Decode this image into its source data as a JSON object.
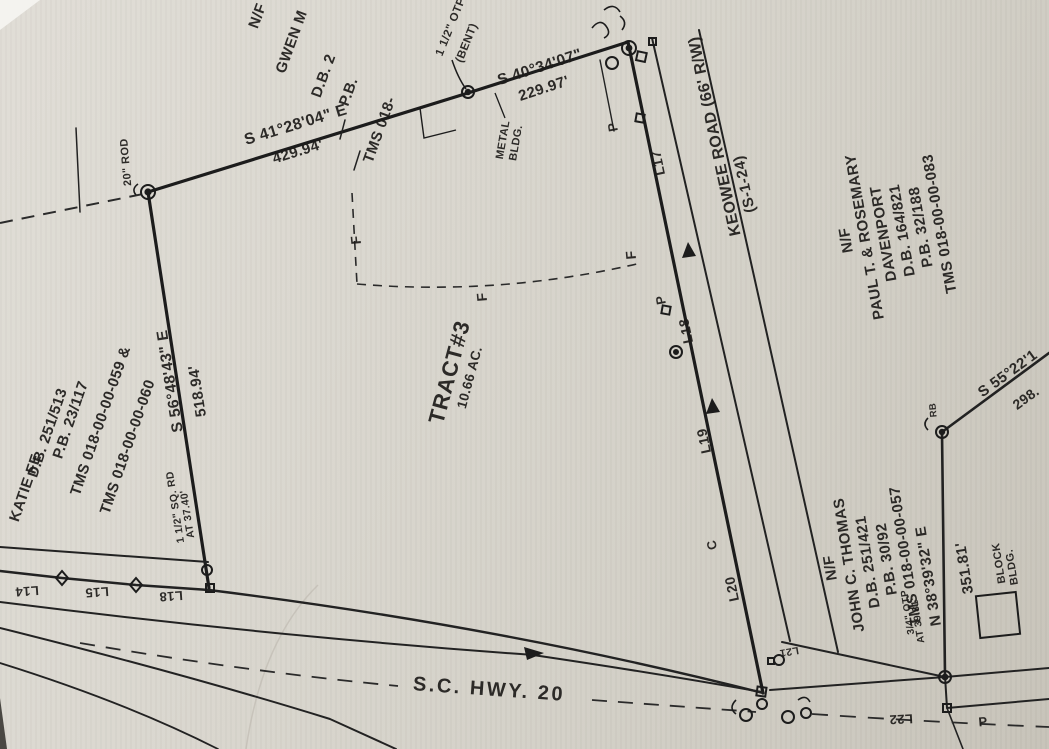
{
  "plat": {
    "tract": {
      "name": "TRACT#3",
      "area": "10.66 AC."
    },
    "roads": {
      "keowee_name": "KEOWEE ROAD (66' R/W)",
      "keowee_route": "(S-1-24)",
      "hwy_name": "S.C. HWY. 20"
    },
    "adjoiners": {
      "north": {
        "nf": "N/F",
        "name": "GWEN M",
        "db": "D.B. 2",
        "pb": "P.B.",
        "tms": "TMS 018-"
      },
      "west": {
        "name": "KATIE FE",
        "db": "D.B. 251/513",
        "pb": "P.B. 23/117",
        "tms1": "TMS 018-00-00-059 &",
        "tms2": "TMS 018-00-00-060"
      },
      "east": {
        "nf": "N/F",
        "name1": "PAUL T. & ROSEMARY",
        "name2": "DAVENPORT",
        "db": "D.B. 164/821",
        "pb": "P.B. 32/188",
        "tms": "TMS 018-00-00-083"
      },
      "south": {
        "nf": "N/F",
        "name": "JOHN C. THOMAS",
        "db": "D.B. 251/421",
        "pb": "P.B. 30/92",
        "tms": "TMS 018-00-00-057"
      }
    },
    "bearings": {
      "north1": {
        "b": "S 41°28'04\" E",
        "d": "429.94'"
      },
      "north2": {
        "b": "S 40°34'07\"",
        "d": "229.97'"
      },
      "west": {
        "b": "S 56°48'43\" E",
        "d": "518.94'"
      },
      "right": {
        "b": "N 38°39'32\" E",
        "d": "351.81'"
      },
      "northeast": {
        "b": "S 55°22'1",
        "d": "298."
      }
    },
    "monuments": {
      "rod20": "20\" ROD",
      "otp_bent_1": "1 1/2\" OTP",
      "otp_bent_2": "(BENT)",
      "sq_rd_1": "1 1/2\" SQ. RD",
      "sq_rd_2": "AT 37.40'",
      "otp34_1": "3/4\" OTP",
      "otp34_2": "AT 39.81'",
      "rb": "RB"
    },
    "buildings": {
      "metal_1": "METAL",
      "metal_2": "BLDG.",
      "block_1": "BLOCK",
      "block_2": "BLDG."
    },
    "segment_labels": {
      "keowee": [
        "L17",
        "L18",
        "L19",
        "L20"
      ],
      "southwest": [
        "L14",
        "L15",
        "L18"
      ],
      "southeast": [
        "L21",
        "L22"
      ]
    },
    "marks": {
      "f": "F",
      "p": "P",
      "c": "C"
    }
  }
}
